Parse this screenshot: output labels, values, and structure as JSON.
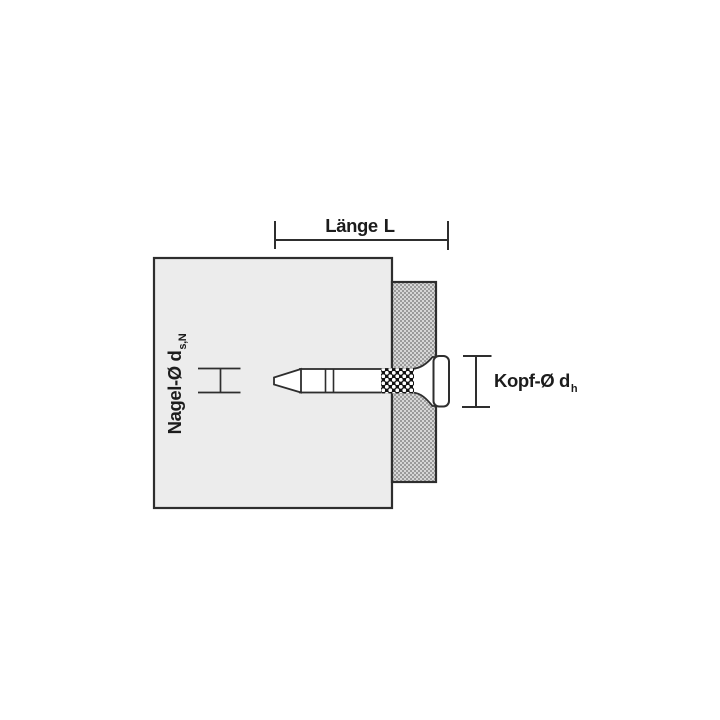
{
  "diagram": {
    "description": "Technical drawing of a fastening nail driven through an attached part into a base material",
    "labels": {
      "length": {
        "word": "Länge",
        "symbol": "L"
      },
      "nail_diameter": {
        "main": "Nagel-Ø d",
        "sub": "s,N"
      },
      "head_diameter": {
        "main": "Kopf-Ø d",
        "sub": "h"
      }
    },
    "colors": {
      "background": "#ffffff",
      "line": "#2e2e2e",
      "text": "#1c1c1c",
      "base_material_fill": "#ececec",
      "fastened_material_bg": "#d7d7d7",
      "fastened_material_dot": "#9b9b9b",
      "nail_fill": "#ffffff",
      "knurl_bg": "#121212",
      "knurl_dot": "#ffffff"
    }
  }
}
